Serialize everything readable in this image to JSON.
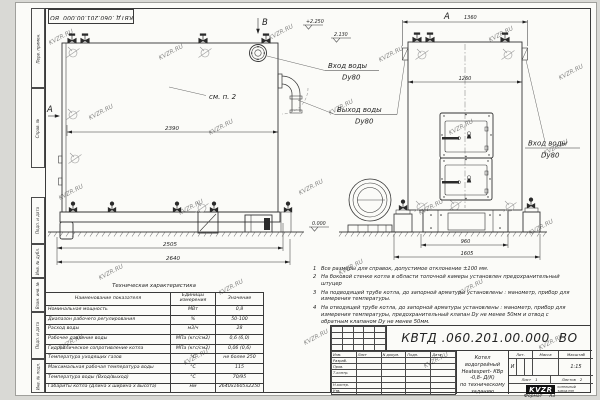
{
  "watermark": {
    "text": "KVZR.RU"
  },
  "doc": {
    "number": "КВТД .060.201.00.000  ВО",
    "format_label": "Формат",
    "format_value": "А3"
  },
  "drawing": {
    "view_b_label": "В",
    "view_a_label": "А",
    "callout_see_item": "см. п. 2",
    "elev_top": "+2.250",
    "elev_mid": "2.130",
    "elev_zero": "0.000",
    "dims": {
      "side_top": "2390",
      "side_mid": "2505",
      "side_bottom": "2640",
      "front_top": "1360",
      "front_inner": "1260",
      "front_base": "960",
      "front_bottom": "1605"
    },
    "labels": {
      "inlet_mid_1": "Вход воды",
      "inlet_mid_2": "Dy80",
      "outlet_1": "Выход воды",
      "outlet_2": "Dy80",
      "inlet_right_1": "Вход воды",
      "inlet_right_2": "Dy80"
    }
  },
  "frame_labels": {
    "col1": "Перв. примен.",
    "col2": "Справ. №",
    "col3": "Подп. и дата",
    "col4": "Инв. № дубл.",
    "col5": "Взам. инв. №",
    "col6": "Подп. и дата",
    "col7": "Инв. № подл."
  },
  "tech_table": {
    "title": "Техническая характеристика",
    "col1": "Наименование показателя",
    "col2": "Единицы измерения",
    "col3": "Значение",
    "rows": [
      {
        "name": "Номинальная мощность",
        "unit": "МВт",
        "value": "0,8"
      },
      {
        "name": "Диапазон рабочего регулирования",
        "unit": "%",
        "value": "50-100"
      },
      {
        "name": "Расход воды",
        "unit": "м3/ч",
        "value": "28"
      },
      {
        "name": "Рабочее давление воды",
        "unit": "МПа (кгс/см2)",
        "value": "0,6 (6,0)"
      },
      {
        "name": "Гидравлическое сопротивление котла",
        "unit": "МПа (кгс/см2)",
        "value": "0,06 (0,6)"
      },
      {
        "name": "Температура уходящих газов",
        "unit": "°С",
        "value": "не более 250"
      },
      {
        "name": "Максимальная рабочая температура воды",
        "unit": "°С",
        "value": "115"
      },
      {
        "name": "Температура воды (Вход/выход)",
        "unit": "°С",
        "value": "70/95"
      },
      {
        "name": "Габариты котла (Длина х ширина х высота)",
        "unit": "мм",
        "value": "2640х1605х2250"
      }
    ]
  },
  "notes": {
    "items": [
      {
        "num": "1",
        "text": "Все размеры для справок, допустимое отклонение ±100 мм."
      },
      {
        "num": "2",
        "text": "На боковой стенке котла в области топочной камеры установлен предохранительный штуцер"
      },
      {
        "num": "3",
        "text": "На  подводящей трубе котла, до запорной арматуры установлены : манометр, прибор для измерения температуры."
      },
      {
        "num": "4",
        "text": "На отводящей трубе котла, до запорной арматуры установлены : манометр, прибор для измерения температуры, предохранительный клапан Dу не менее 50мм и отвод с обратным клапаном Dу не менее 50мм."
      }
    ]
  },
  "title_block": {
    "sig_header": [
      "Изм.",
      "Лист",
      "N докум.",
      "Подп.",
      "Дата"
    ],
    "sig_rows": [
      "Разраб.",
      "Пров.",
      "Т.контр.",
      "",
      "Н.контр.",
      "Утв."
    ],
    "name_line1": "Котел водогрейный",
    "name_line2": "Heatexpert- КВр -0,8- Д(К)",
    "name_line3": "по техническому заданию",
    "lit_label": "Лит.",
    "lit_value": "И",
    "mass_label": "Масса",
    "scale_label": "Масштаб",
    "scale_value": "1:15",
    "sheet_label": "Лист",
    "sheet_value": "1",
    "sheets_label": "Листов",
    "sheets_value": "2",
    "logo_text": "KVZR",
    "logo_caption1": "КОТЕЛЬНЫЙ",
    "logo_caption2": "ЗАВОД РЭП"
  }
}
